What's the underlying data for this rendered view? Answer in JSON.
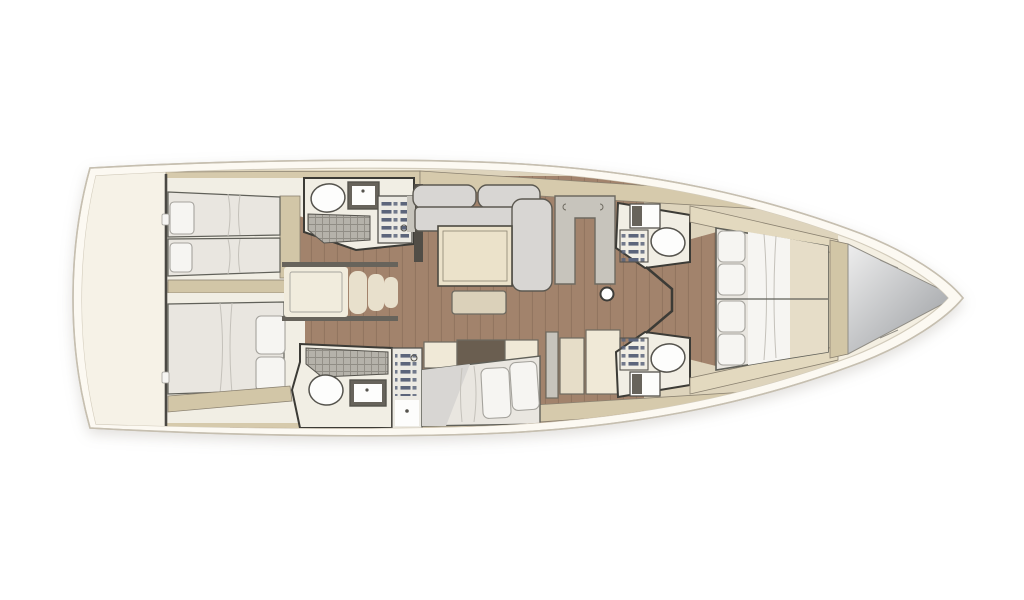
{
  "diagram": {
    "type": "yacht-interior-floor-plan",
    "orientation": {
      "bow": "right",
      "stern": "left"
    },
    "rooms": [
      {
        "id": "aft-cabin-port",
        "label": "aft cabin with twin single beds"
      },
      {
        "id": "aft-cabin-starboard",
        "label": "aft cabin with double bed"
      },
      {
        "id": "aft-head-port",
        "label": "aft bathroom with shower, toilet and sink"
      },
      {
        "id": "aft-head-starboard",
        "label": "aft bathroom with shower, toilet and sink"
      },
      {
        "id": "companionway",
        "label": "companionway entry steps"
      },
      {
        "id": "salon",
        "label": "salon with L-shaped sofa, table and bench"
      },
      {
        "id": "lounge-settee",
        "label": "starboard settee with cushions"
      },
      {
        "id": "galley-units",
        "label": "galley / storage units"
      },
      {
        "id": "fwd-head-port",
        "label": "forward bathroom"
      },
      {
        "id": "fwd-head-starboard",
        "label": "forward bathroom"
      },
      {
        "id": "owner-cabin",
        "label": "forward owner cabin with double berth"
      },
      {
        "id": "sail-locker",
        "label": "bow sail locker"
      }
    ],
    "colors": {
      "page_bg": "#ffffff",
      "hull_fill": "#fcf9f2",
      "hull_stroke": "#c6bfb0",
      "deck_fill": "#f4efe2",
      "deck_stroke": "#d2cbbb",
      "stern_platform": "#f6f2e7",
      "stern_wall": "#4a4843",
      "interior_base": "#ded4bc",
      "deck_band": "#d6caac",
      "deck_band_light": "#e3d9bf",
      "wood": "#a2836c",
      "plank": "#7d6350",
      "room_bg": "#f1eee4",
      "mattress": "#e9e6e0",
      "mattress_stroke": "#606059",
      "pillow": "#f6f5f2",
      "pillow_stroke": "#a5a39d",
      "fold": "#c4c1ba",
      "bed_frame": "#d2c6a7",
      "frame_stroke": "#8b8271",
      "sofa": "#d8d6d3",
      "sofa_stroke": "#5c5951",
      "table": "#ebe2ca",
      "table_stroke": "#4c4a41",
      "ottoman": "#dbd1ba",
      "cream_cab": "#f0e9d7",
      "tan_cab": "#e6ddc8",
      "gray_cab": "#c7c4bc",
      "cab_stroke": "#6e6a60",
      "dark_wall": "#3c3b36",
      "fixture_white": "#fdfdfc",
      "fixture_stroke": "#55534d",
      "counter_dark": "#67635b",
      "shower_base": "#b5b2aa",
      "shower_line": "#908d85",
      "slat": "#5c657b",
      "slat_panel": "#eceae3",
      "step": "#e8e0cc",
      "landing": "#f1ecdd",
      "open_shelf": "#6a5e50",
      "dark_unit": "#514d46",
      "knob": "#d8d5cf",
      "locker_tan": "#d2c6a6",
      "locker_light": "#eeeeee",
      "locker_dark": "#96999d",
      "mast_fill": "#ffffff",
      "mast_stroke": "#3d3c38"
    }
  }
}
